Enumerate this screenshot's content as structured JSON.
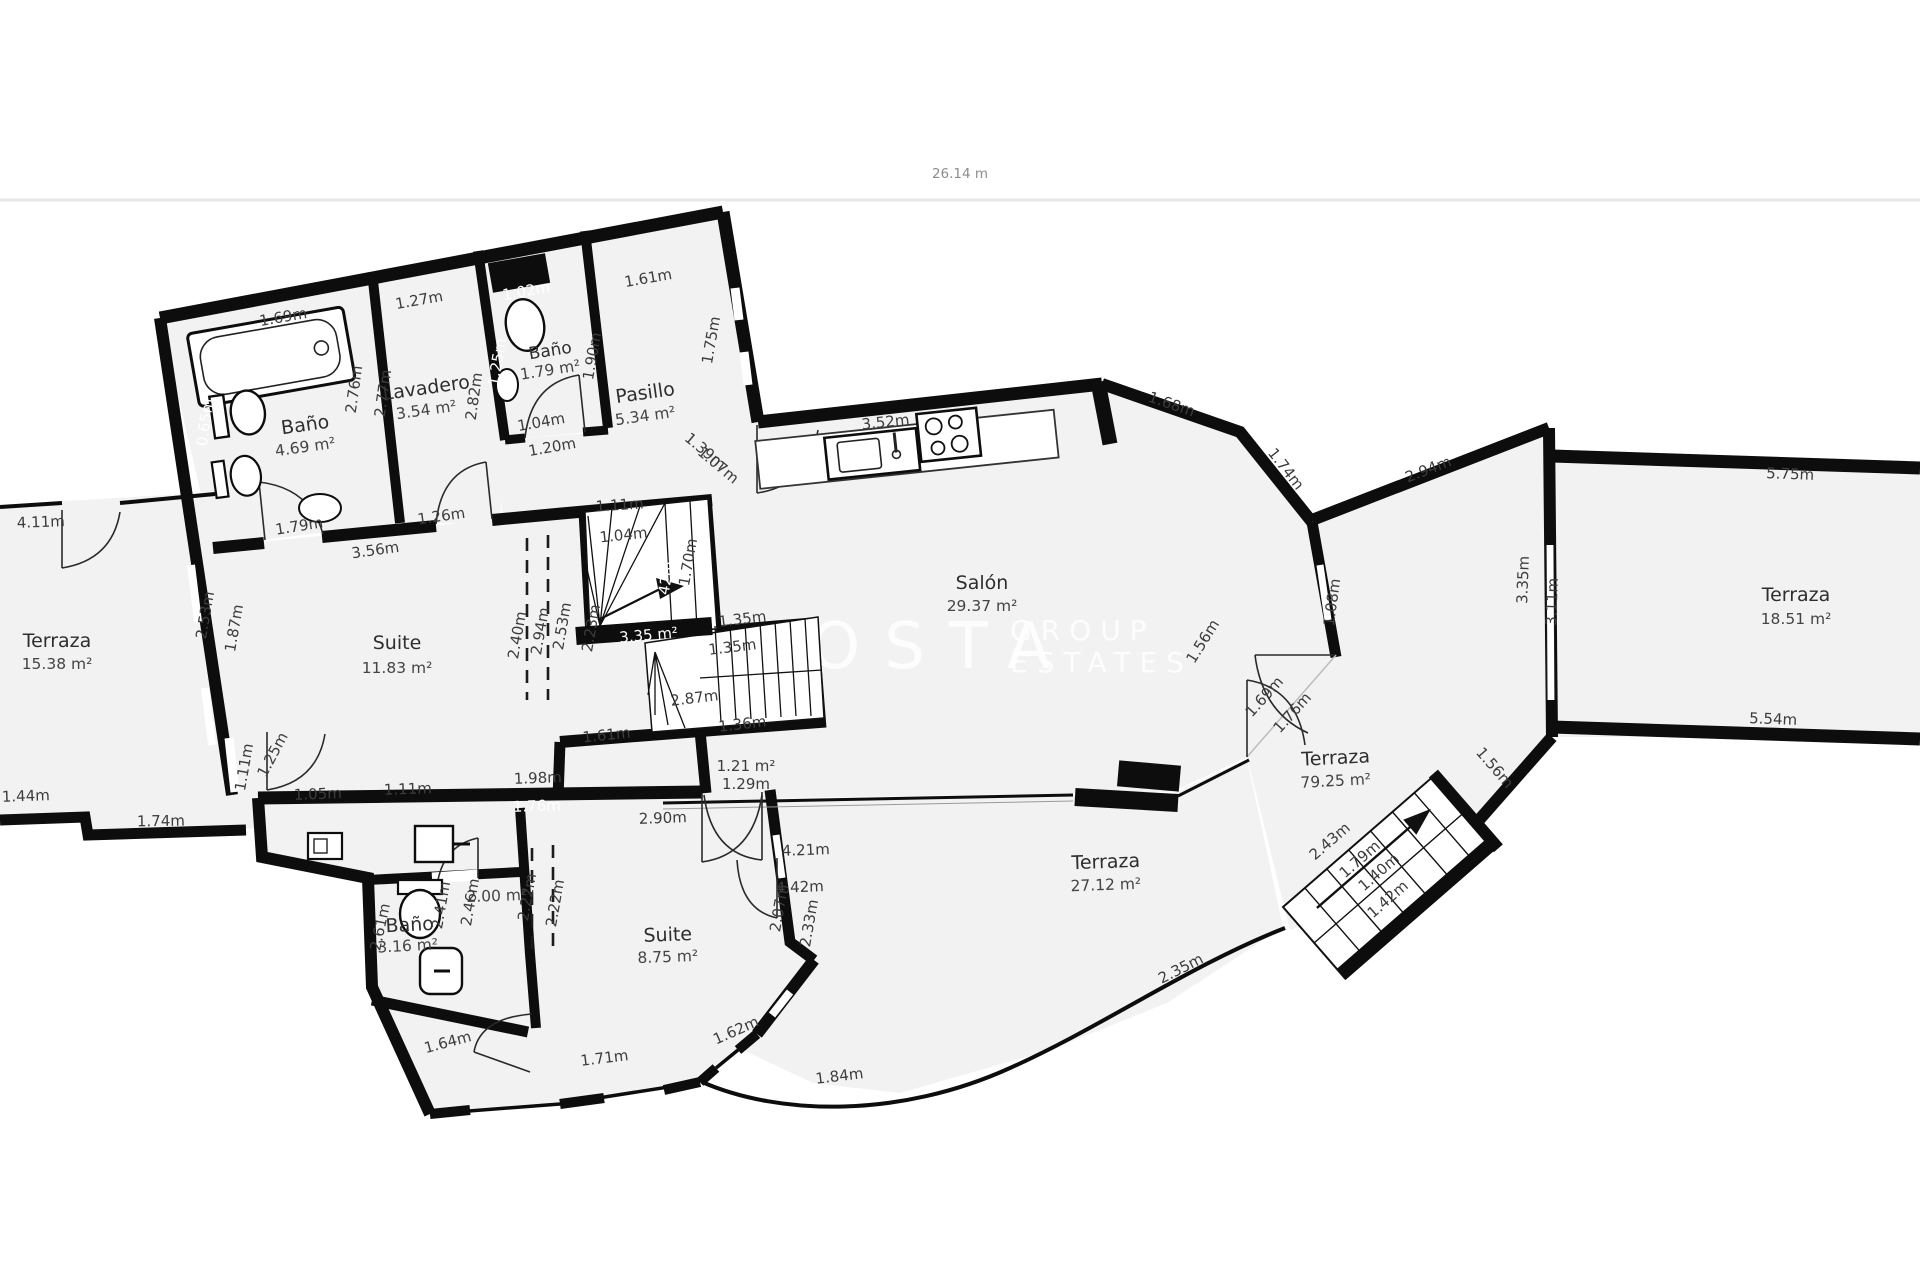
{
  "header": {
    "overall_width": "26.14 m"
  },
  "watermark": {
    "brand": "COSTA",
    "sub1": "GROUP",
    "sub2": "ESTATES"
  },
  "rooms": [
    {
      "name": "Baño",
      "area": "4.69 m²"
    },
    {
      "name": "Lavadero",
      "area": "3.54 m²"
    },
    {
      "name": "Baño",
      "area": "1.79 m²"
    },
    {
      "name": "Pasillo",
      "area": "5.34 m²"
    },
    {
      "name": "Salón",
      "area": "29.37 m²"
    },
    {
      "name": "Suite",
      "area": "11.83 m²"
    },
    {
      "name": "Terraza",
      "area": "15.38 m²"
    },
    {
      "name": "Baño",
      "area": "3.16 m²"
    },
    {
      "name": "Suite",
      "area": "8.75 m²"
    },
    {
      "name": "Terraza",
      "area": "27.12 m²"
    },
    {
      "name": "Terraza",
      "area": "79.25 m²"
    },
    {
      "name": "Terraza",
      "area": "18.51 m²"
    }
  ],
  "areas": {
    "stairs": "3.35 m²",
    "closet": "2.00 m²"
  },
  "dims": [
    "1.69m",
    "1.27m",
    "1.02m",
    "1.61m",
    "1.75m",
    "1.90m",
    "1.25m",
    "1.04m",
    "1.20m",
    "2.76m",
    "2.77m",
    "2.82m",
    "0.65m",
    "1.79m",
    "3.56m",
    "1.26m",
    "1.39m",
    "1.07m",
    "3.52m",
    "1.68m",
    "1.74m",
    "2.94m",
    "1.08m",
    "1.69m",
    "1.76m",
    "3.35m",
    "3.11m",
    "5.75m",
    "5.54m",
    "1.56m",
    "2.43m",
    "1.79m",
    "1.40m",
    "1.42m",
    "2.35m",
    "1.84m",
    "4.21m",
    "4.42m",
    "1.61m",
    "2.87m",
    "1.35m",
    "1.35m",
    "1.36m",
    "1.21 m²",
    "1.29m",
    "1.11m",
    "1.04m",
    "1.70m",
    "1.42m",
    "2.40m",
    "2.94m",
    "2.53m",
    "2.23m",
    "4.11m",
    "2.53m",
    "1.87m",
    "1.44m",
    "1.74m",
    "1.05m",
    "1.11m",
    "1.11m",
    "1.25m",
    "1.98m",
    "1.76m",
    "2.90m",
    "2.41m",
    "2.46m",
    "2.22m",
    "2.22m",
    "2.61m",
    "1.64m",
    "1.71m",
    "1.62m",
    "2.07m",
    "2.33m",
    "1.56m"
  ]
}
